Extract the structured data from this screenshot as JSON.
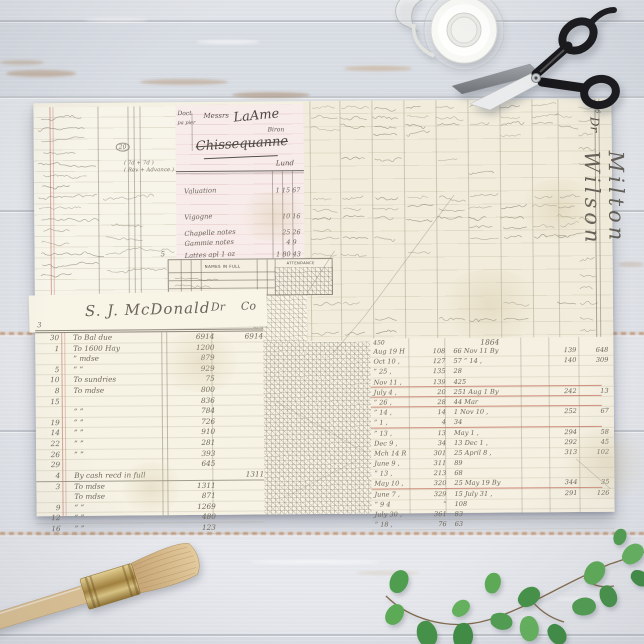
{
  "sheet": {
    "left_strip": {
      "circled_note": "20",
      "bracket_note_1": "( 7d + 7d )",
      "bracket_note_2": "( Rev + Advance )",
      "corner_mark": "5"
    },
    "receipt": {
      "corner_label": "Doct",
      "margin_label": "pa pier",
      "salutation": "Messrs",
      "name_line1": "LaAme",
      "name_suffix": "Biron",
      "name_line2": "Chissequanne",
      "tail_note": "Lund",
      "rows": [
        {
          "label": "Valuation",
          "col1": "1 15",
          "col2": "67"
        },
        {
          "label": "Vigogne",
          "col1": "10",
          "col2": "16"
        },
        {
          "label": "Chapelle notes",
          "col1": "25",
          "col2": "26"
        },
        {
          "label": "Gammie notes",
          "col1": "4",
          "col2": "9"
        },
        {
          "label": "Lattes apl 1 oz",
          "col1": "1 80",
          "col2": "43"
        }
      ]
    },
    "top_ledger": {
      "page_number": "346",
      "dr_label": "Dr",
      "owner_script": "Milton Wilson"
    },
    "register_strip": {
      "names_header": "NAMES IN FULL",
      "attendance_header": "ATTENDANCE"
    },
    "mcdonald_ledger": {
      "title_script": "S. J. McDonald",
      "dr_label": "Dr",
      "co_label": "Co",
      "corner_mark": "3",
      "rows": [
        {
          "day": "30",
          "desc": "To Bal due",
          "amt": "6914",
          "amt2": "6914"
        },
        {
          "day": "1",
          "desc": "To 1600 Hay",
          "amt": "1200",
          "amt2": ""
        },
        {
          "day": "",
          "desc": "”  mdse",
          "amt": "879",
          "amt2": ""
        },
        {
          "day": "5",
          "desc": "”    ”",
          "amt": "929",
          "amt2": ""
        },
        {
          "day": "10",
          "desc": "To sundries",
          "amt": "75",
          "amt2": ""
        },
        {
          "day": "8",
          "desc": "To mdse",
          "amt": "800",
          "amt2": ""
        },
        {
          "day": "15",
          "desc": "",
          "amt": "836",
          "amt2": ""
        },
        {
          "day": "",
          "desc": "”    ”",
          "amt": "784",
          "amt2": ""
        },
        {
          "day": "19",
          "desc": "”    ”",
          "amt": "726",
          "amt2": ""
        },
        {
          "day": "14",
          "desc": "”    ”",
          "amt": "910",
          "amt2": ""
        },
        {
          "day": "22",
          "desc": "”    ”",
          "amt": "281",
          "amt2": ""
        },
        {
          "day": "26",
          "desc": "”    ”",
          "amt": "393",
          "amt2": ""
        },
        {
          "day": "29",
          "desc": "",
          "amt": "645",
          "amt2": ""
        },
        {
          "day": "4",
          "desc": "By cash recd in full",
          "amt": "",
          "amt2": "1311",
          "rule": true
        },
        {
          "day": "3",
          "desc": "To mdse",
          "amt": "1311",
          "amt2": ""
        },
        {
          "day": "",
          "desc": "To mdse",
          "amt": "871",
          "amt2": ""
        },
        {
          "day": "9",
          "desc": "”    ”",
          "amt": "1269",
          "amt2": ""
        },
        {
          "day": "12",
          "desc": "”    ”",
          "amt": "480",
          "amt2": ""
        },
        {
          "day": "16",
          "desc": "”    ”",
          "amt": "123",
          "amt2": ""
        }
      ]
    },
    "year_ledger": {
      "year_heading": "1864",
      "corner_mark": "450",
      "rows": [
        {
          "date": "Aug 19 H",
          "a": "108",
          "b": "66 Nov 11 By",
          "c": "139",
          "d": "648",
          "redline": false
        },
        {
          "date": "Oct 10 ,",
          "a": "127",
          "b": "57 ” 14 ,",
          "c": "140",
          "d": "309",
          "redline": false
        },
        {
          "date": "” 25 ,",
          "a": "135",
          "b": "28",
          "c": "",
          "d": "",
          "redline": false
        },
        {
          "date": "Nov 11 ,",
          "a": "139",
          "b": "425",
          "c": "",
          "d": "",
          "redline": true
        },
        {
          "date": "July 4 ,",
          "a": "20",
          "b": "251 Aug 1 By",
          "c": "242",
          "d": "13",
          "redline": true
        },
        {
          "date": "” 26 ,",
          "a": "28",
          "b": "44 Mar",
          "c": "",
          "d": "",
          "redline": true
        },
        {
          "date": "” 14 ,",
          "a": "14",
          "b": "1 Nov 10 ,",
          "c": "252",
          "d": "67",
          "redline": false
        },
        {
          "date": "” 1 ,",
          "a": "4",
          "b": "34",
          "c": "",
          "d": "",
          "redline": true
        },
        {
          "date": "” 13 ,",
          "a": "13",
          "b": "May 1 ,",
          "c": "294",
          "d": "58",
          "redline": false
        },
        {
          "date": "Dec 9 ,",
          "a": "34",
          "b": "13 Dec 1 ,",
          "c": "292",
          "d": "45",
          "redline": false
        },
        {
          "date": "Mch 14 R",
          "a": "301",
          "b": "25 April 8 ,",
          "c": "313",
          "d": "102",
          "redline": false
        },
        {
          "date": "June 9 ,",
          "a": "311",
          "b": "89",
          "c": "",
          "d": "",
          "redline": false
        },
        {
          "date": "” 13 ,",
          "a": "213",
          "b": "68",
          "c": "",
          "d": "",
          "redline": false
        },
        {
          "date": "May 10 ,",
          "a": "320",
          "b": "25 May 19 By",
          "c": "344",
          "d": "35",
          "redline": true
        },
        {
          "date": "June 7 ,",
          "a": "329",
          "b": "15 July 31 ,",
          "c": "291",
          "d": "126",
          "redline": false
        },
        {
          "date": "” 9 4",
          "a": "”",
          "b": "108",
          "c": "",
          "d": "",
          "redline": false
        },
        {
          "date": "July 30 ,",
          "a": "361",
          "b": "83",
          "c": "",
          "d": "",
          "redline": false
        },
        {
          "date": "” 18 ,",
          "a": "76",
          "b": "63",
          "c": "",
          "d": "",
          "redline": false
        }
      ]
    }
  },
  "colors": {
    "accent_red": "#c2675a",
    "paper_cream": "#f4f0e2",
    "paper_pink": "#f8ecea",
    "leaf_green": "#4f9e4f",
    "wood_tone": "#e0e3e8"
  }
}
